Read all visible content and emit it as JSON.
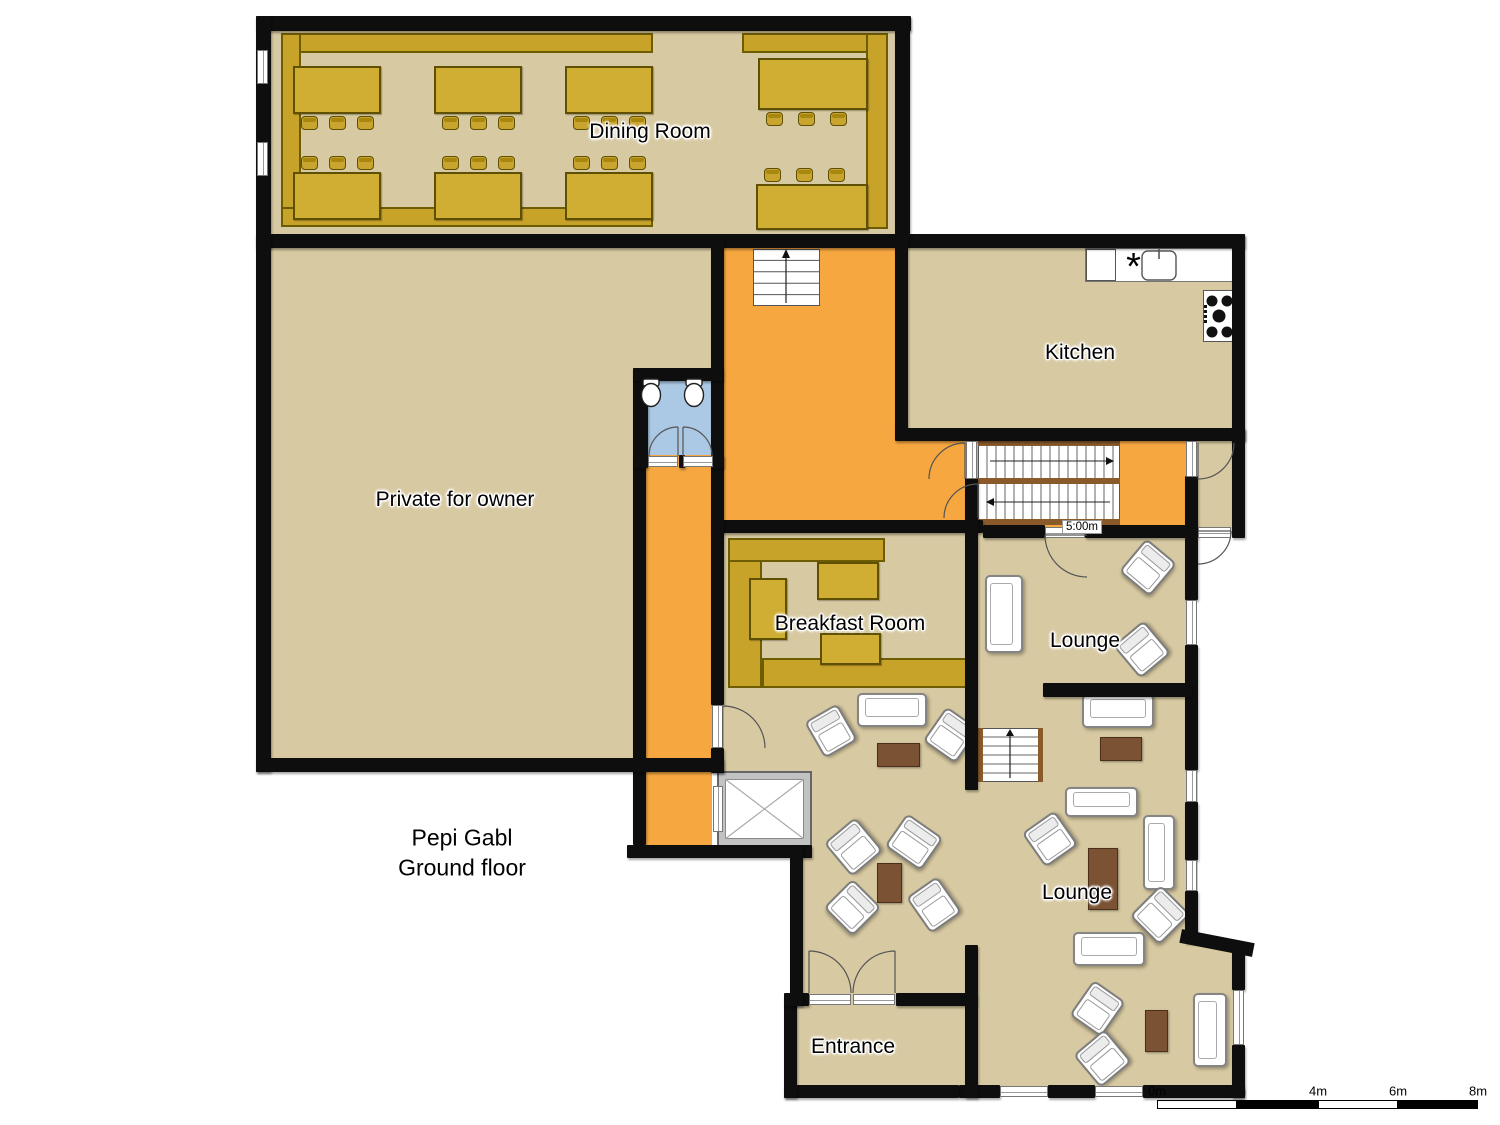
{
  "title": {
    "line1": "Pepi Gabl",
    "line2": "Ground floor"
  },
  "rooms": {
    "dining": "Dining Room",
    "kitchen": "Kitchen",
    "private": "Private for owner",
    "breakfast": "Breakfast Room",
    "lounge_upper": "Lounge",
    "lounge_main": "Lounge",
    "entrance": "Entrance"
  },
  "stair_dimension": "5:00m",
  "scale_bar": {
    "labels": [
      "0m",
      "2m",
      "4m",
      "6m",
      "8m"
    ]
  },
  "colors": {
    "floor": "#d7c9a1",
    "hall": "#f6a740",
    "bath": "#abc8e4",
    "wall": "#0e0e0e",
    "wood": "#c8a32a",
    "wood_dark": "#6e5c00",
    "table_gold": "#cfae33",
    "brown": "#7b5233",
    "white": "#ffffff"
  },
  "plan": {
    "floors": [
      [
        263,
        23,
        640,
        218,
        "beige"
      ],
      [
        263,
        241,
        453,
        524,
        "beige"
      ],
      [
        716,
        241,
        192,
        292,
        "orange"
      ],
      [
        902,
        435,
        340,
        97,
        "orange"
      ],
      [
        1192,
        438,
        46,
        96,
        "beige"
      ],
      [
        902,
        241,
        336,
        194,
        "beige"
      ],
      [
        640,
        373,
        77,
        84,
        "blue"
      ],
      [
        646,
        455,
        66,
        392,
        "orange"
      ],
      [
        724,
        533,
        241,
        162,
        "beige"
      ],
      [
        978,
        533,
        214,
        160,
        "beige"
      ],
      [
        724,
        693,
        514,
        399,
        "beige"
      ],
      [
        1198,
        693,
        40,
        252,
        "white"
      ],
      [
        712,
        858,
        78,
        250,
        "white"
      ],
      [
        797,
        1001,
        168,
        90,
        "beige"
      ]
    ],
    "walls": [
      [
        256,
        16,
        655,
        15
      ],
      [
        256,
        16,
        15,
        232
      ],
      [
        256,
        234,
        989,
        14
      ],
      [
        895,
        16,
        15,
        225
      ],
      [
        895,
        241,
        13,
        194
      ],
      [
        1232,
        234,
        13,
        206
      ],
      [
        895,
        428,
        350,
        13
      ],
      [
        1232,
        428,
        13,
        110
      ],
      [
        1185,
        476,
        13,
        62
      ],
      [
        711,
        520,
        272,
        13
      ],
      [
        965,
        478,
        13,
        312
      ],
      [
        983,
        525,
        62,
        13
      ],
      [
        1085,
        525,
        113,
        13
      ],
      [
        711,
        240,
        13,
        465
      ],
      [
        711,
        748,
        13,
        25
      ],
      [
        633,
        455,
        13,
        390
      ],
      [
        627,
        845,
        185,
        13
      ],
      [
        633,
        368,
        15,
        100
      ],
      [
        633,
        368,
        90,
        13
      ],
      [
        679,
        455,
        6,
        13
      ],
      [
        712,
        455,
        12,
        13
      ],
      [
        256,
        234,
        15,
        538
      ],
      [
        256,
        758,
        468,
        14
      ],
      [
        1185,
        538,
        13,
        62
      ],
      [
        1185,
        645,
        13,
        125
      ],
      [
        1185,
        802,
        13,
        58
      ],
      [
        1185,
        891,
        13,
        52
      ],
      [
        1043,
        683,
        149,
        14
      ],
      [
        1232,
        950,
        13,
        40
      ],
      [
        1232,
        1045,
        13,
        53
      ],
      [
        959,
        1085,
        41,
        13
      ],
      [
        1048,
        1085,
        47,
        13
      ],
      [
        1143,
        1085,
        101,
        13
      ],
      [
        784,
        1085,
        175,
        13
      ],
      [
        784,
        998,
        13,
        100
      ],
      [
        784,
        993,
        25,
        13
      ],
      [
        896,
        993,
        81,
        13
      ],
      [
        965,
        945,
        13,
        153
      ],
      [
        790,
        845,
        13,
        161
      ]
    ],
    "wall_diag": [
      1180,
      936,
      74,
      14,
      11
    ],
    "windows": [
      [
        1186,
        441,
        11,
        36,
        "v"
      ],
      [
        1186,
        600,
        11,
        45,
        "v"
      ],
      [
        1186,
        770,
        11,
        32,
        "v"
      ],
      [
        1186,
        860,
        11,
        31,
        "v"
      ],
      [
        1233,
        990,
        11,
        55,
        "v"
      ],
      [
        1000,
        1086,
        48,
        11,
        "h"
      ],
      [
        1095,
        1086,
        48,
        11,
        "h"
      ],
      [
        257,
        50,
        11,
        34,
        "v"
      ],
      [
        257,
        142,
        11,
        34,
        "v"
      ]
    ],
    "thresholds": [
      [
        712,
        705,
        11,
        43,
        "v"
      ],
      [
        966,
        441,
        11,
        38,
        "v"
      ],
      [
        1045,
        527,
        40,
        11,
        "h"
      ],
      [
        1198,
        527,
        33,
        11,
        "h"
      ],
      [
        809,
        994,
        42,
        11,
        "h"
      ],
      [
        853,
        994,
        42,
        11,
        "h"
      ],
      [
        648,
        456,
        30,
        11,
        "h"
      ],
      [
        683,
        456,
        30,
        11,
        "h"
      ],
      [
        713,
        786,
        10,
        46,
        "v"
      ]
    ],
    "benches": [
      [
        281,
        33,
        372,
        20
      ],
      [
        281,
        33,
        20,
        194
      ],
      [
        281,
        207,
        372,
        20
      ],
      [
        742,
        33,
        146,
        20
      ],
      [
        866,
        33,
        22,
        196
      ],
      [
        728,
        538,
        34,
        150
      ],
      [
        728,
        538,
        157,
        24
      ],
      [
        762,
        658,
        208,
        30
      ]
    ],
    "gtables": [
      [
        293,
        66,
        88,
        48
      ],
      [
        434,
        66,
        88,
        48
      ],
      [
        565,
        66,
        88,
        48
      ],
      [
        293,
        172,
        88,
        48
      ],
      [
        434,
        172,
        88,
        48
      ],
      [
        565,
        172,
        88,
        48
      ],
      [
        758,
        58,
        110,
        52
      ],
      [
        756,
        184,
        112,
        46
      ],
      [
        749,
        578,
        38,
        62
      ],
      [
        817,
        562,
        62,
        38
      ],
      [
        820,
        633,
        61,
        32
      ]
    ],
    "chairs": [
      [
        301,
        116
      ],
      [
        329,
        116
      ],
      [
        357,
        116
      ],
      [
        442,
        116
      ],
      [
        470,
        116
      ],
      [
        498,
        116
      ],
      [
        573,
        116
      ],
      [
        601,
        116
      ],
      [
        629,
        116
      ],
      [
        301,
        156
      ],
      [
        329,
        156
      ],
      [
        357,
        156
      ],
      [
        442,
        156
      ],
      [
        470,
        156
      ],
      [
        498,
        156
      ],
      [
        573,
        156
      ],
      [
        601,
        156
      ],
      [
        629,
        156
      ],
      [
        766,
        112
      ],
      [
        798,
        112
      ],
      [
        830,
        112
      ],
      [
        764,
        168
      ],
      [
        796,
        168
      ],
      [
        828,
        168
      ]
    ],
    "btables": [
      [
        877,
        743,
        43,
        24
      ],
      [
        1100,
        737,
        42,
        24
      ],
      [
        1088,
        848,
        30,
        62
      ],
      [
        877,
        863,
        25,
        40
      ],
      [
        1145,
        1010,
        23,
        42
      ]
    ],
    "sofas": [
      [
        985,
        575,
        38,
        78
      ],
      [
        857,
        693,
        70,
        34
      ],
      [
        1082,
        694,
        72,
        34
      ],
      [
        1065,
        787,
        73,
        30
      ],
      [
        1143,
        815,
        32,
        75
      ],
      [
        1073,
        932,
        72,
        34
      ],
      [
        1193,
        993,
        34,
        74
      ]
    ],
    "armchairs": [
      [
        1128,
        546,
        40,
        43,
        40
      ],
      [
        1122,
        628,
        40,
        43,
        -40
      ],
      [
        812,
        710,
        38,
        42,
        -30
      ],
      [
        931,
        714,
        40,
        42,
        35
      ],
      [
        1030,
        818,
        40,
        42,
        -35
      ],
      [
        1139,
        893,
        42,
        44,
        45
      ],
      [
        833,
        825,
        41,
        44,
        -40
      ],
      [
        892,
        822,
        44,
        40,
        35
      ],
      [
        832,
        887,
        41,
        41,
        45
      ],
      [
        915,
        883,
        38,
        44,
        -35
      ],
      [
        1078,
        987,
        39,
        43,
        35
      ],
      [
        1082,
        1037,
        41,
        43,
        -40
      ]
    ],
    "stairs": {
      "small": [
        753,
        249,
        67,
        57
      ],
      "main": [
        978,
        441,
        142,
        84
      ],
      "mid": [
        978,
        728,
        65,
        54
      ]
    },
    "elevator": [
      717,
      771,
      95,
      76
    ],
    "kitchen": {
      "counter": [
        1085,
        248,
        152,
        34
      ],
      "dishbox": [
        1086,
        249,
        30,
        32
      ],
      "sink": [
        1142,
        251,
        34,
        29
      ],
      "cooktop": [
        1203,
        290,
        33,
        52
      ]
    },
    "toilets": [
      [
        651,
        381
      ],
      [
        694,
        381
      ]
    ],
    "doors": [
      "M678 427 A29 29 0 0 0 649 456 M678 456 L678 427",
      "M683 427 A29 29 0 0 1 712 456 M683 456 L683 427",
      "M723 706 A42 42 0 0 1 765 748 M723 748 L723 706",
      "M965 443 A36 36 0 0 0 929 479 M965 479 L965 443",
      "M978 484 A34 34 0 0 0 944 518 M978 518 L978 484",
      "M1045 535 A42 42 0 0 0 1087 577 M1045 535 L1087 535",
      "M1198 479 A36 36 0 0 0 1234 443 M1198 443 L1198 479",
      "M1231 531 A33 33 0 0 1 1198 564 M1198 531 L1231 531",
      "M809 951 A42 42 0 0 1 851 993 M809 993 L809 951",
      "M895 951 A42 42 0 0 0 853 993 M895 993 L895 951"
    ],
    "scale_segments": [
      [
        1157,
        1100,
        80,
        9,
        "#ffffff"
      ],
      [
        1237,
        1100,
        81,
        9,
        "#000000"
      ],
      [
        1318,
        1100,
        80,
        9,
        "#ffffff"
      ],
      [
        1398,
        1100,
        80,
        9,
        "#000000"
      ]
    ]
  }
}
